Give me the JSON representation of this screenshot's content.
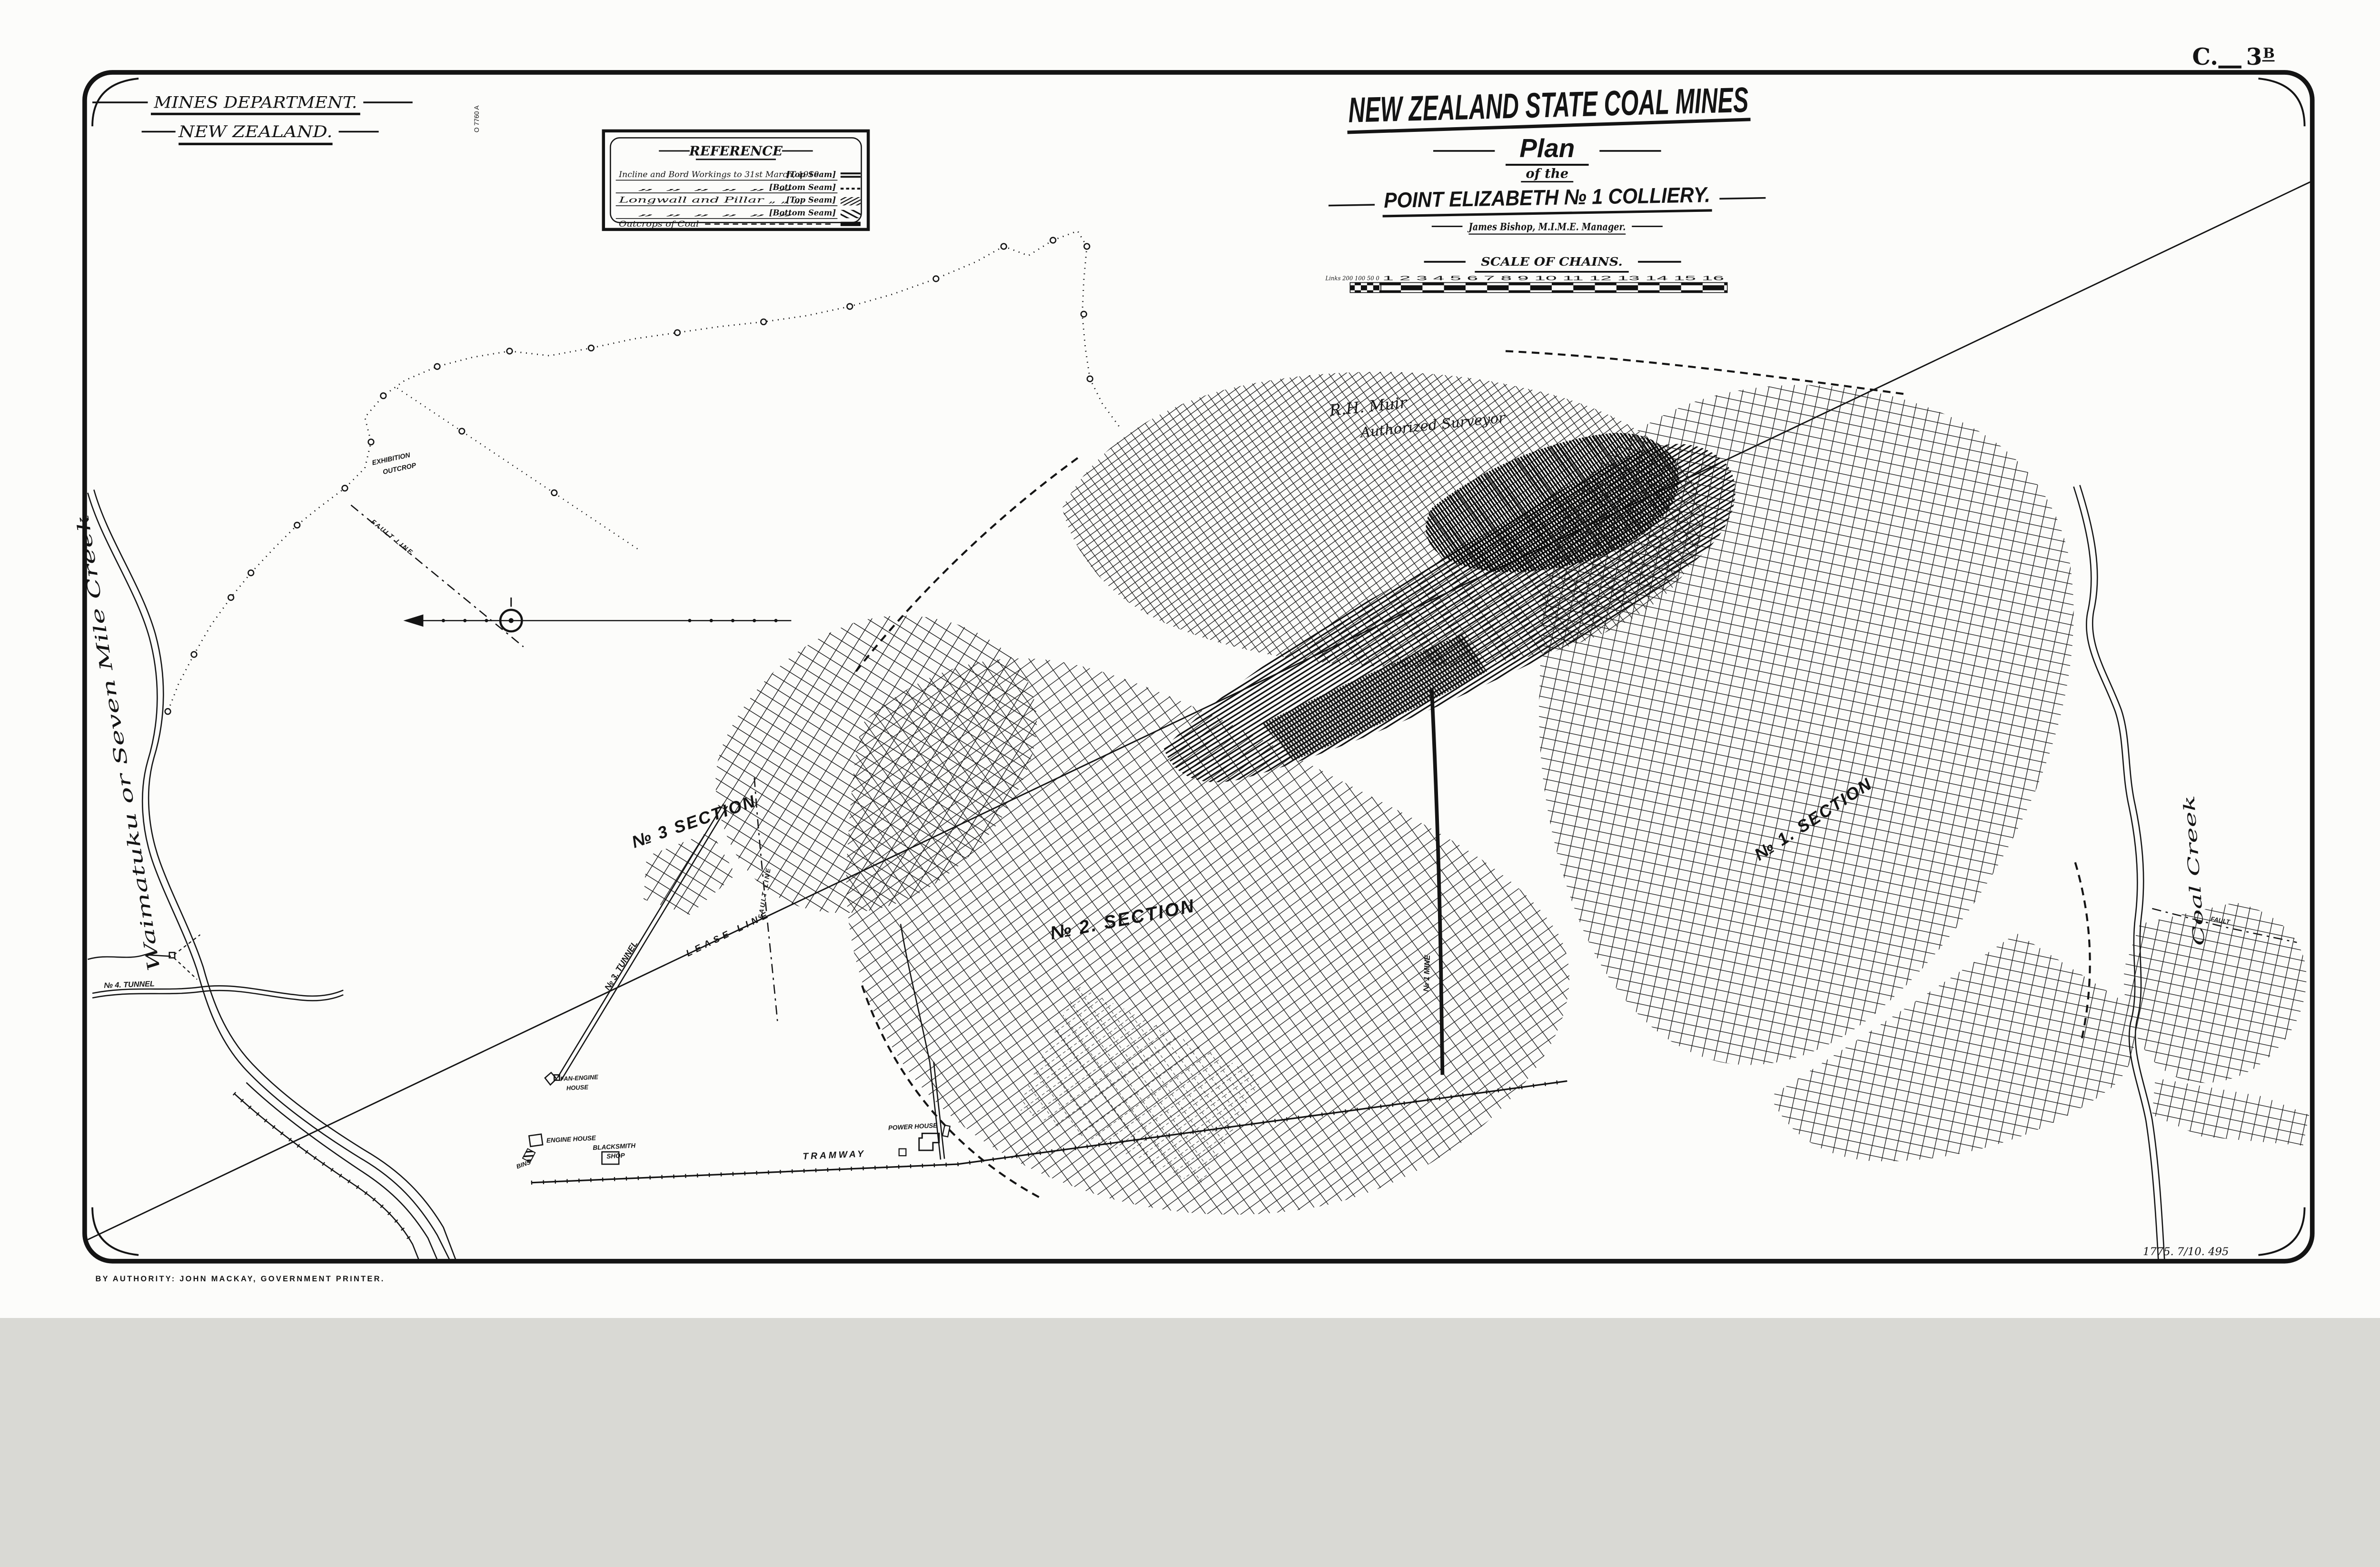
{
  "plate": {
    "prefix": "C.",
    "number": "3",
    "suffix": "B"
  },
  "department": {
    "line1": "MINES DEPARTMENT.",
    "line2": "NEW ZEALAND."
  },
  "file_number": "O 7760 A",
  "reference": {
    "title": "REFERENCE",
    "rows": [
      {
        "label": "Incline and Bord Workings to 31st March, 1910",
        "seam": "[Top Seam]",
        "symbol": "double-line"
      },
      {
        "label": "„      „      „      „      „      „",
        "seam": "[Bottom Seam]",
        "symbol": "dashed-line"
      },
      {
        "label": "Longwall and Pillar      „      „      „",
        "seam": "[Top Seam]",
        "symbol": "fine-hatch"
      },
      {
        "label": "„      „      „      „      „      „",
        "seam": "[Bottom Seam]",
        "symbol": "coarse-hatch"
      },
      {
        "label": "Outcrops of Coal",
        "seam": "",
        "symbol": "solid-bar"
      }
    ]
  },
  "title_block": {
    "organization": "NEW ZEALAND STATE COAL MINES",
    "doc_type": "Plan",
    "connector": "of the",
    "subject": "POINT ELIZABETH № 1 COLLIERY.",
    "manager": "James Bishop, M.I.M.E. Manager."
  },
  "scale_bar": {
    "title": "SCALE OF CHAINS.",
    "links_labels": "Links 200 100 50 0",
    "chain_labels": "1 2 3 4 5 6 7 8 9 10 11 12 13 14 15 16"
  },
  "surveyor_note": {
    "line1": "R.H. Muir",
    "line2": "Authorized Surveyor"
  },
  "map_labels": {
    "creek_left": "Waimatuku or Seven Mile Creek",
    "creek_right": "Coal Creek",
    "tunnel_3": "№ 3. TUNNEL",
    "tunnel_4": "№ 4. TUNNEL",
    "section_1": "№ 1. SECTION",
    "section_2": "№ 2. SECTION",
    "section_3": "№ 3  SECTION",
    "lease_line": "LEASE LINE",
    "fault_line_a": "FAULT LINE",
    "fault_line_b": "FAULT LINE",
    "fault_c": "FAULT",
    "mine_no1": "№ 1 MINE",
    "outcrop_line1": "EXHIBITION",
    "outcrop_line2": "OUTCROP",
    "tramway": "TRAMWAY",
    "bins": "BINS",
    "blacksmith_line1": "BLACKSMITH",
    "blacksmith_line2": "SHOP",
    "engine_house": "ENGINE HOUSE",
    "fan_engine_line1": "FAN-ENGINE",
    "fan_engine_line2": "HOUSE",
    "power_house": "POWER HOUSE"
  },
  "footer": {
    "authority": "BY AUTHORITY: JOHN MACKAY, GOVERNMENT PRINTER.",
    "print_code": "1775. 7/10. 495"
  }
}
